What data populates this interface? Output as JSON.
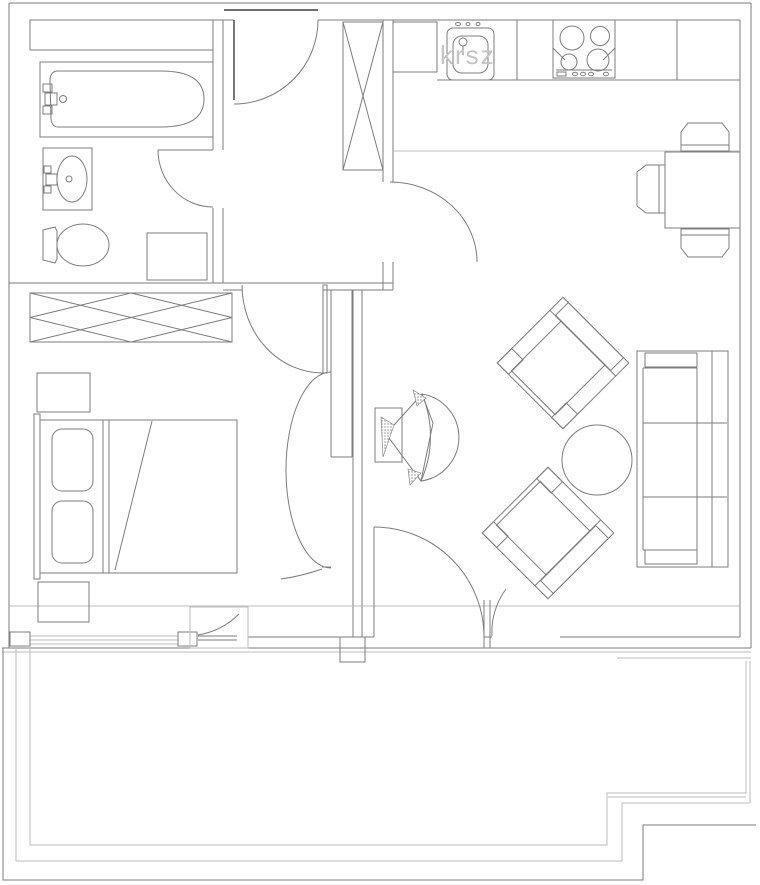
{
  "drawing": {
    "type": "apartment-floor-plan-line-drawing",
    "canvas": {
      "width": 760,
      "height": 885
    },
    "background": "#ffffff"
  },
  "colors": {
    "line": "#7d7d7d",
    "light_line": "#bdbdbd",
    "dark_line": "#3f3f3f",
    "label_text": "#c4c4c4",
    "hatch_fill": "#6e6e6e"
  },
  "labels": {
    "kitchen_sink": "krsz"
  },
  "rooms": [
    {
      "name": "bathroom",
      "position": "top-left"
    },
    {
      "name": "entry-hall",
      "position": "top-center"
    },
    {
      "name": "kitchen",
      "position": "top-right"
    },
    {
      "name": "bedroom",
      "position": "left"
    },
    {
      "name": "living-room",
      "position": "right"
    },
    {
      "name": "balcony",
      "position": "bottom"
    }
  ],
  "fixtures": {
    "bathroom": [
      "shelf",
      "bathtub",
      "bath-faucet",
      "washbasin",
      "basin-faucet",
      "toilet",
      "washing-machine",
      "swing-door"
    ],
    "entry_hall": [
      "entry-door",
      "x-wardrobe"
    ],
    "kitchen": [
      "counter",
      "corner-cabinet",
      "sink",
      "stove-4-burner",
      "swing-door",
      "dining-table",
      "chair-top",
      "chair-bottom",
      "chair-left"
    ],
    "bedroom": [
      "x-wardrobe",
      "nightstand-top",
      "double-bed",
      "pillow-left",
      "pillow-right",
      "nightstand-bottom",
      "swing-door",
      "balcony-window",
      "casement-window"
    ],
    "living_room": [
      "wall-tv-swivel",
      "armchair-upper",
      "armchair-lower",
      "round-coffee-table",
      "sofa-3-seat",
      "balcony-double-door"
    ],
    "balcony": [
      "railing-triple-line",
      "stepped-corner-bottom-right"
    ]
  }
}
